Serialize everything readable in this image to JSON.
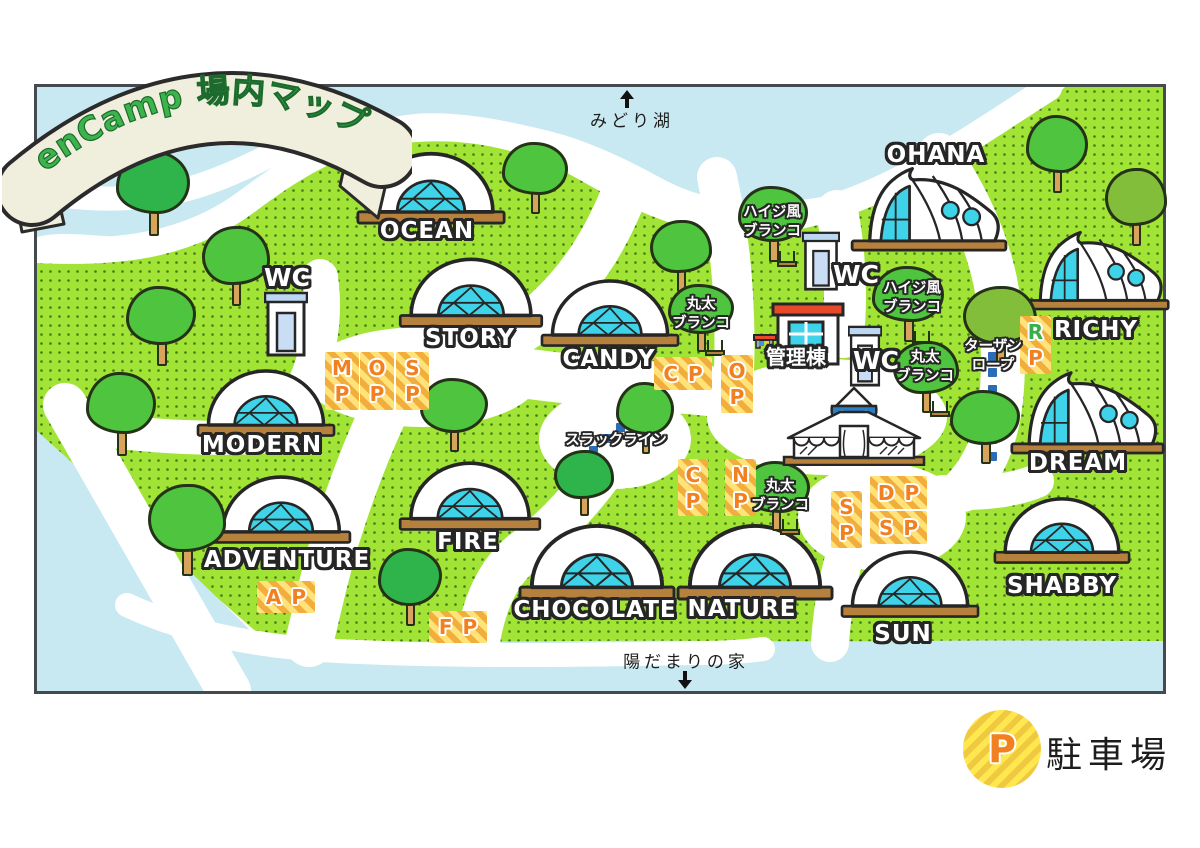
{
  "title_banner": {
    "text": "enCamp 場内マップ",
    "text_color": "#3CB44B",
    "ribbon_color": "#F0EEDD"
  },
  "map": {
    "colors": {
      "grass": "#A2E436",
      "dot": "#3F7A15",
      "water": "#C8E9F1",
      "cyan": "#3ED3E8",
      "base_brown": "#B5813D",
      "sign_yellow": "#FFE27A",
      "sign_stripe": "#F2AE3C",
      "sign_letter": "#F08020",
      "outline": "#262626",
      "rope_blue": "#2B6CB8"
    }
  },
  "off_map_labels": {
    "north": {
      "label": "みどり湖"
    },
    "south": {
      "label": "陽だまりの家"
    }
  },
  "legend": {
    "symbol": "P",
    "label": "駐車場"
  },
  "tents": [
    {
      "id": "ocean",
      "name": "OCEAN",
      "style": "dome",
      "box": [
        356,
        146,
        150
      ],
      "label": [
        427,
        231
      ]
    },
    {
      "id": "story",
      "name": "STORY",
      "style": "dome",
      "box": [
        398,
        252,
        146
      ],
      "label": [
        470,
        338
      ]
    },
    {
      "id": "candy",
      "name": "CANDY",
      "style": "dome",
      "box": [
        540,
        274,
        140
      ],
      "label": [
        609,
        359
      ]
    },
    {
      "id": "modern",
      "name": "MODERN",
      "style": "dome",
      "box": [
        196,
        364,
        140
      ],
      "label": [
        262,
        445
      ]
    },
    {
      "id": "adventure",
      "name": "ADVENTURE",
      "style": "dome",
      "box": [
        210,
        470,
        142
      ],
      "label": [
        287,
        560
      ]
    },
    {
      "id": "fire",
      "name": "FIRE",
      "style": "dome",
      "box": [
        398,
        456,
        144
      ],
      "label": [
        468,
        542
      ]
    },
    {
      "id": "chocolate",
      "name": "CHOCOLATE",
      "style": "dome",
      "box": [
        518,
        518,
        158
      ],
      "label": [
        595,
        610
      ]
    },
    {
      "id": "nature",
      "name": "NATURE",
      "style": "dome",
      "box": [
        676,
        518,
        158
      ],
      "label": [
        742,
        609
      ]
    },
    {
      "id": "sun",
      "name": "SUN",
      "style": "dome",
      "box": [
        840,
        545,
        140
      ],
      "label": [
        903,
        634
      ]
    },
    {
      "id": "shabby",
      "name": "SHABBY",
      "style": "dome",
      "box": [
        993,
        492,
        138
      ],
      "label": [
        1062,
        586
      ]
    },
    {
      "id": "ohana",
      "name": "OHANA",
      "style": "curve",
      "box": [
        850,
        164,
        158
      ],
      "label": [
        936,
        155
      ]
    },
    {
      "id": "richy",
      "name": "RICHY",
      "style": "curve",
      "box": [
        1022,
        228,
        148
      ],
      "label": [
        1096,
        330
      ]
    },
    {
      "id": "dream",
      "name": "DREAM",
      "style": "curve",
      "box": [
        1010,
        368,
        155
      ],
      "label": [
        1078,
        463
      ]
    }
  ],
  "parking_signs": [
    {
      "id": "mp",
      "letters": [
        "M",
        "P"
      ],
      "dir": "v",
      "box": [
        325,
        352,
        34,
        58
      ]
    },
    {
      "id": "op-west",
      "letters": [
        "O",
        "P"
      ],
      "dir": "v",
      "box": [
        360,
        352,
        34,
        58
      ]
    },
    {
      "id": "sp-west",
      "letters": [
        "S",
        "P"
      ],
      "dir": "v",
      "box": [
        396,
        352,
        33,
        58
      ]
    },
    {
      "id": "cp-candy",
      "letters": [
        "C",
        "P"
      ],
      "dir": "h",
      "box": [
        654,
        357,
        58,
        33
      ]
    },
    {
      "id": "op-center",
      "letters": [
        "O",
        "P"
      ],
      "dir": "v",
      "box": [
        721,
        355,
        32,
        58
      ]
    },
    {
      "id": "cp-south",
      "letters": [
        "C",
        "P"
      ],
      "dir": "v",
      "box": [
        678,
        459,
        30,
        57
      ]
    },
    {
      "id": "np",
      "letters": [
        "N",
        "P"
      ],
      "dir": "v",
      "box": [
        725,
        459,
        31,
        57
      ]
    },
    {
      "id": "sp-sun",
      "letters": [
        "S",
        "P"
      ],
      "dir": "v",
      "box": [
        831,
        491,
        31,
        57
      ]
    },
    {
      "id": "dp",
      "letters": [
        "D",
        "P"
      ],
      "dir": "h",
      "box": [
        870,
        476,
        57,
        33
      ]
    },
    {
      "id": "sp-shabby",
      "letters": [
        "S",
        "P"
      ],
      "dir": "h",
      "box": [
        870,
        511,
        57,
        33
      ]
    },
    {
      "id": "ap",
      "letters": [
        "A",
        "P"
      ],
      "dir": "h",
      "box": [
        257,
        581,
        58,
        32
      ]
    },
    {
      "id": "fp",
      "letters": [
        "F",
        "P"
      ],
      "dir": "h",
      "box": [
        429,
        611,
        58,
        32
      ]
    },
    {
      "id": "rp",
      "letters": [
        "R",
        "P"
      ],
      "dir": "v",
      "box": [
        1020,
        316,
        31,
        58
      ],
      "first_color": "#3BAE4B"
    }
  ],
  "facility_labels": [
    {
      "id": "haiji-swing-north",
      "text": "ハイジ風\nブランコ",
      "pos": [
        772,
        222
      ]
    },
    {
      "id": "haiji-swing-east",
      "text": "ハイジ風\nブランコ",
      "pos": [
        912,
        298
      ]
    },
    {
      "id": "log-swing-candy",
      "text": "丸太\nブランコ",
      "pos": [
        701,
        314
      ]
    },
    {
      "id": "log-swing-admin",
      "text": "丸太\nブランコ",
      "pos": [
        925,
        367
      ]
    },
    {
      "id": "log-swing-nature",
      "text": "丸太\nブランコ",
      "pos": [
        780,
        496
      ]
    },
    {
      "id": "slackline",
      "text": "スラックライン",
      "pos": [
        616,
        441
      ]
    },
    {
      "id": "tarzan-rope",
      "text": "ターザン\nロープ",
      "pos": [
        993,
        356
      ]
    },
    {
      "id": "wc-north",
      "text": "WC",
      "pos": [
        287,
        278
      ],
      "size": 25
    },
    {
      "id": "wc-ohana",
      "text": "WC",
      "pos": [
        856,
        275
      ],
      "size": 25
    },
    {
      "id": "wc-admin",
      "text": "WC",
      "pos": [
        876,
        361
      ],
      "size": 25
    },
    {
      "id": "admin-label",
      "text": "管理棟",
      "pos": [
        796,
        358
      ],
      "size": 20
    }
  ],
  "buildings": [
    {
      "id": "wc-building-north",
      "type": "wc",
      "box": [
        264,
        291,
        44,
        66
      ]
    },
    {
      "id": "wc-building-ohana",
      "type": "wc",
      "box": [
        802,
        231,
        38,
        60
      ]
    },
    {
      "id": "wc-building-admin",
      "type": "wc",
      "box": [
        848,
        325,
        34,
        62
      ]
    },
    {
      "id": "admin-building",
      "type": "admin",
      "box": [
        753,
        302,
        92,
        64
      ]
    },
    {
      "id": "yurt",
      "type": "yurt",
      "box": [
        782,
        386,
        144,
        80
      ]
    }
  ],
  "ropes": [
    {
      "id": "slackline-rope",
      "from": [
        648,
        404
      ],
      "to": [
        580,
        462
      ]
    },
    {
      "id": "tarzan-line",
      "from": [
        992,
        306
      ],
      "to": [
        992,
        456
      ]
    }
  ],
  "trees": [
    [
      116,
      150,
      74,
      86,
      1,
      0
    ],
    [
      202,
      226,
      68,
      80,
      0,
      0
    ],
    [
      126,
      286,
      70,
      80,
      0,
      0
    ],
    [
      86,
      372,
      70,
      84,
      0,
      0
    ],
    [
      148,
      484,
      78,
      92,
      0,
      0
    ],
    [
      378,
      548,
      64,
      78,
      1,
      0
    ],
    [
      502,
      142,
      66,
      72,
      0,
      0
    ],
    [
      650,
      220,
      62,
      72,
      0,
      0
    ],
    [
      420,
      378,
      68,
      74,
      0,
      0
    ],
    [
      616,
      382,
      58,
      72,
      0,
      0
    ],
    [
      554,
      450,
      60,
      66,
      1,
      0
    ],
    [
      738,
      186,
      70,
      76,
      0,
      1
    ],
    [
      872,
      266,
      72,
      76,
      0,
      1
    ],
    [
      893,
      341,
      66,
      72,
      0,
      1
    ],
    [
      668,
      284,
      66,
      68,
      0,
      1
    ],
    [
      742,
      461,
      68,
      70,
      0,
      1
    ],
    [
      963,
      286,
      74,
      78,
      2,
      0
    ],
    [
      950,
      390,
      70,
      74,
      0,
      0
    ],
    [
      1026,
      115,
      62,
      78,
      0,
      0
    ],
    [
      1105,
      168,
      62,
      78,
      2,
      0
    ]
  ]
}
